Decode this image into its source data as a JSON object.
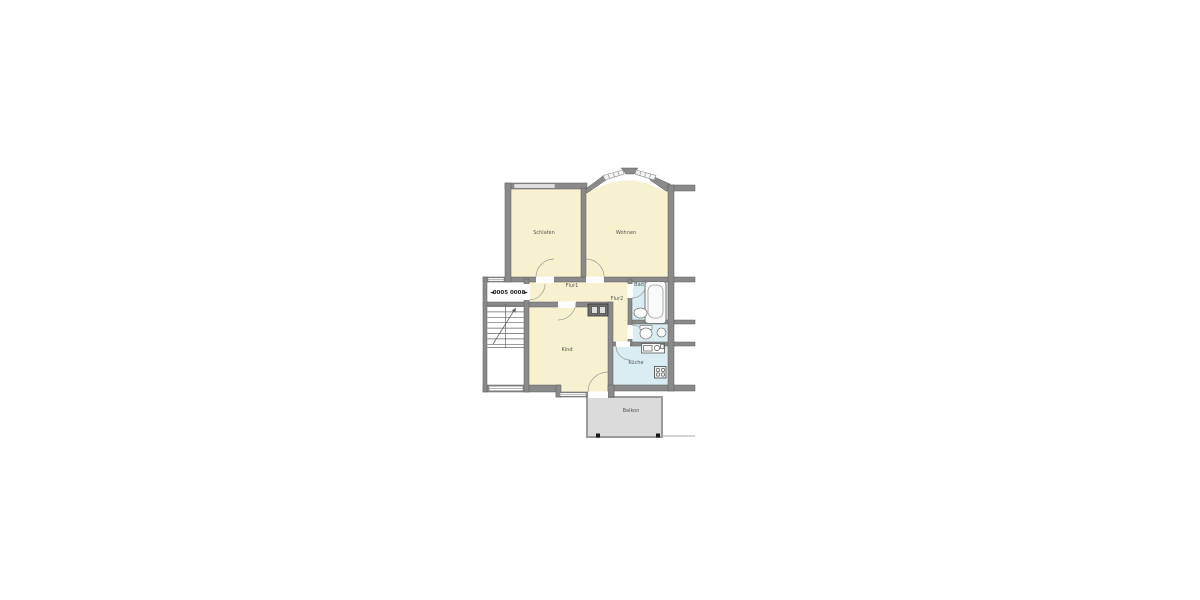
{
  "plan": {
    "type": "apartment-floor-plan",
    "apartment_label": {
      "left_arrow": "◄",
      "number": "0005 0008",
      "right_arrow": "►"
    },
    "rooms": {
      "schlafen": {
        "label": "Schlafen"
      },
      "wohnen": {
        "label": "Wohnen"
      },
      "flur1": {
        "label": "Flur1"
      },
      "flur2": {
        "label": "Flur2"
      },
      "bad": {
        "label": "Bad"
      },
      "kind": {
        "label": "Kind"
      },
      "kueche": {
        "label": "Küche"
      },
      "balkon": {
        "label": "Balkon"
      }
    },
    "fixtures": {
      "bathtub": "bathtub-icon",
      "bad_sink": "sink-icon",
      "toilet": "toilet-icon",
      "wc_basin": "washbasin-icon",
      "kitchen_sink": "kitchen-sink-icon",
      "stove": "stove-icon",
      "stairs": "staircase-icon",
      "shaft": "installation-shaft-icon",
      "balcony_posts": "balcony-post-icon"
    },
    "colors": {
      "room_fill": "#F8F1CF",
      "wet_fill": "#D9EDF2",
      "balcony_fill": "#DBDBDB",
      "wall": "#8A8A8A",
      "wall_outline": "#5A5A5A",
      "window_fill": "#FFFFFF",
      "fixture_stroke": "#777777",
      "label": "#555555"
    }
  }
}
